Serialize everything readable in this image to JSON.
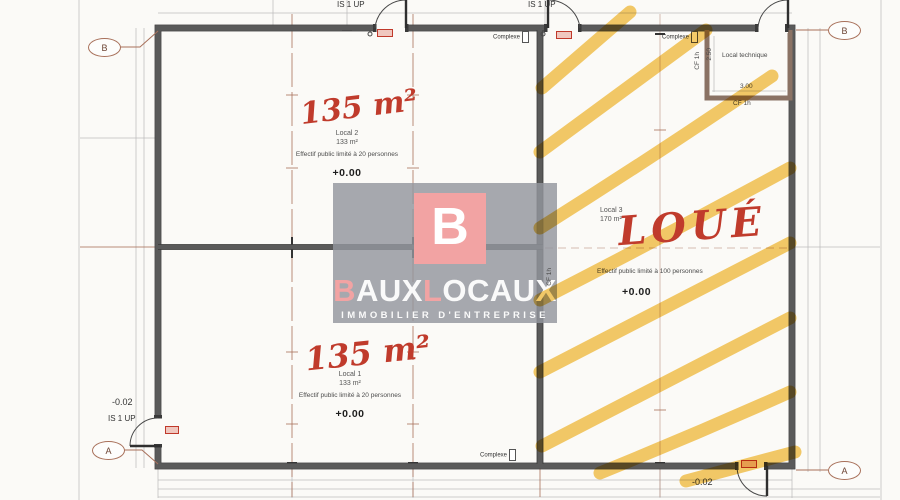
{
  "colors": {
    "paper": "#fbfaf7",
    "wall": "#5a5a5a",
    "technique_wall": "#8a7264",
    "grid": "#a8705a",
    "dim": "#bcbcbc",
    "accent_red": "#c03b2c",
    "highlighter": "#f3bd3e",
    "overlay_gray": "#9396a0",
    "logo_pink": "#f2a3a3",
    "logo_white": "#fafafa"
  },
  "grid_bubbles": {
    "top_left": "B",
    "top_right": "B",
    "bottom_left": "A",
    "bottom_right": "A"
  },
  "exits": {
    "label": "IS 1 UP"
  },
  "levels": {
    "ground": "+0.00",
    "exterior": "-0.02"
  },
  "fire_labels": {
    "cf": "CF 1h",
    "complexe": "Complexe"
  },
  "rooms": {
    "local2": {
      "name": "Local 2",
      "area": "133 m²",
      "capacity": "Effectif public limité à 20 personnes",
      "level": "+0.00",
      "annotation": "135 m²"
    },
    "local1": {
      "name": "Local 1",
      "area": "133 m²",
      "capacity": "Effectif public limité à 20 personnes",
      "level": "+0.00",
      "annotation": "135 m²"
    },
    "local3": {
      "name": "Local 3",
      "area": "170 m²",
      "capacity": "Effectif public limité à 100 personnes",
      "level": "+0.00",
      "annotation": "LOUÉ"
    },
    "technique": {
      "name": "Local technique",
      "dim_width": "3.00",
      "dim_height": "2.50"
    }
  },
  "watermark": {
    "monogram": "B",
    "brand": [
      {
        "t": "B"
      },
      {
        "t": "AUX"
      },
      {
        "t": "L"
      },
      {
        "t": "OCAUX"
      }
    ],
    "tagline": "IMMOBILIER D'ENTREPRISE"
  }
}
